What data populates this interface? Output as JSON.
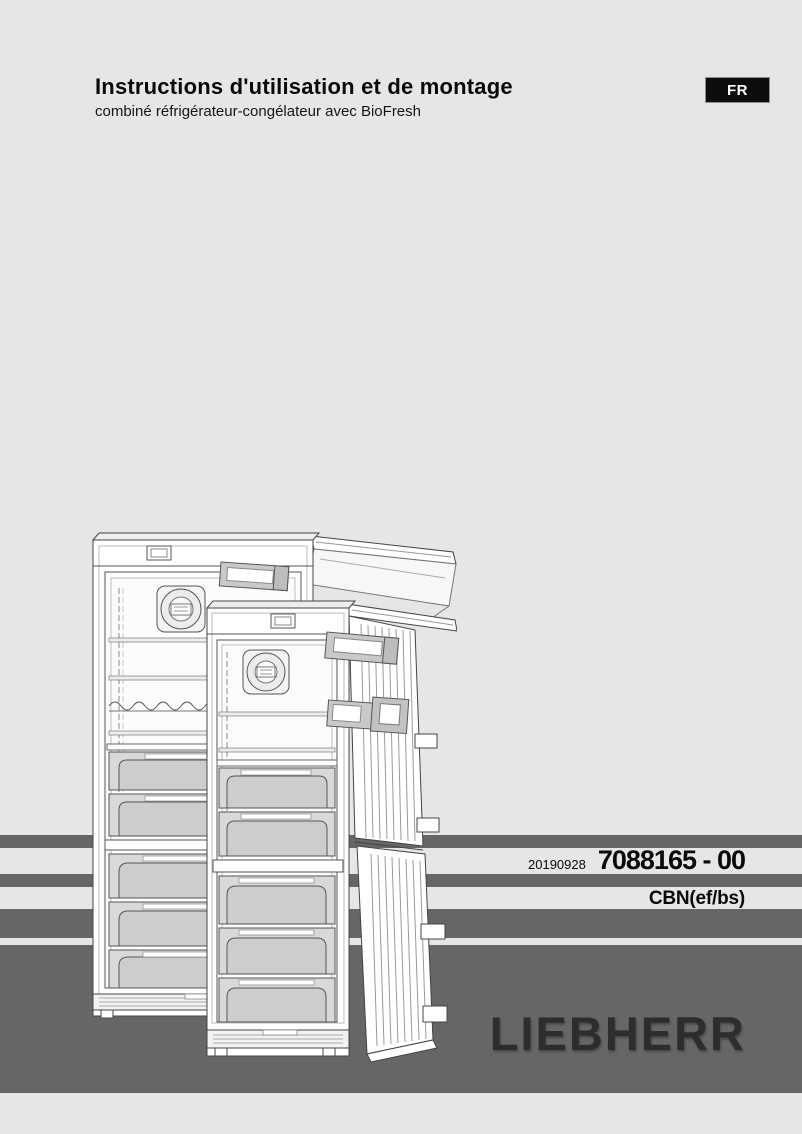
{
  "page": {
    "background_color": "#e6e6e6",
    "stripe_color": "#666666"
  },
  "header": {
    "title": "Instructions d'utilisation et de montage",
    "subtitle": "combiné réfrigérateur-congélateur avec BioFresh",
    "language_badge": {
      "label": "FR",
      "bg_color": "#0c0c0c",
      "text_color": "#ffffff"
    }
  },
  "publication": {
    "date_code": "20190928",
    "document_number": "7088165 - 00",
    "model_series": "CBN(ef/bs)"
  },
  "brand": {
    "logo_text": "LIEBHERR",
    "logo_color": "#2d2d2d"
  },
  "illustration": {
    "name": "fridge-freezer-line-drawing",
    "description": "Two refrigerator-freezer combinations with BioFresh shown with open doors, shelves and drawers"
  }
}
